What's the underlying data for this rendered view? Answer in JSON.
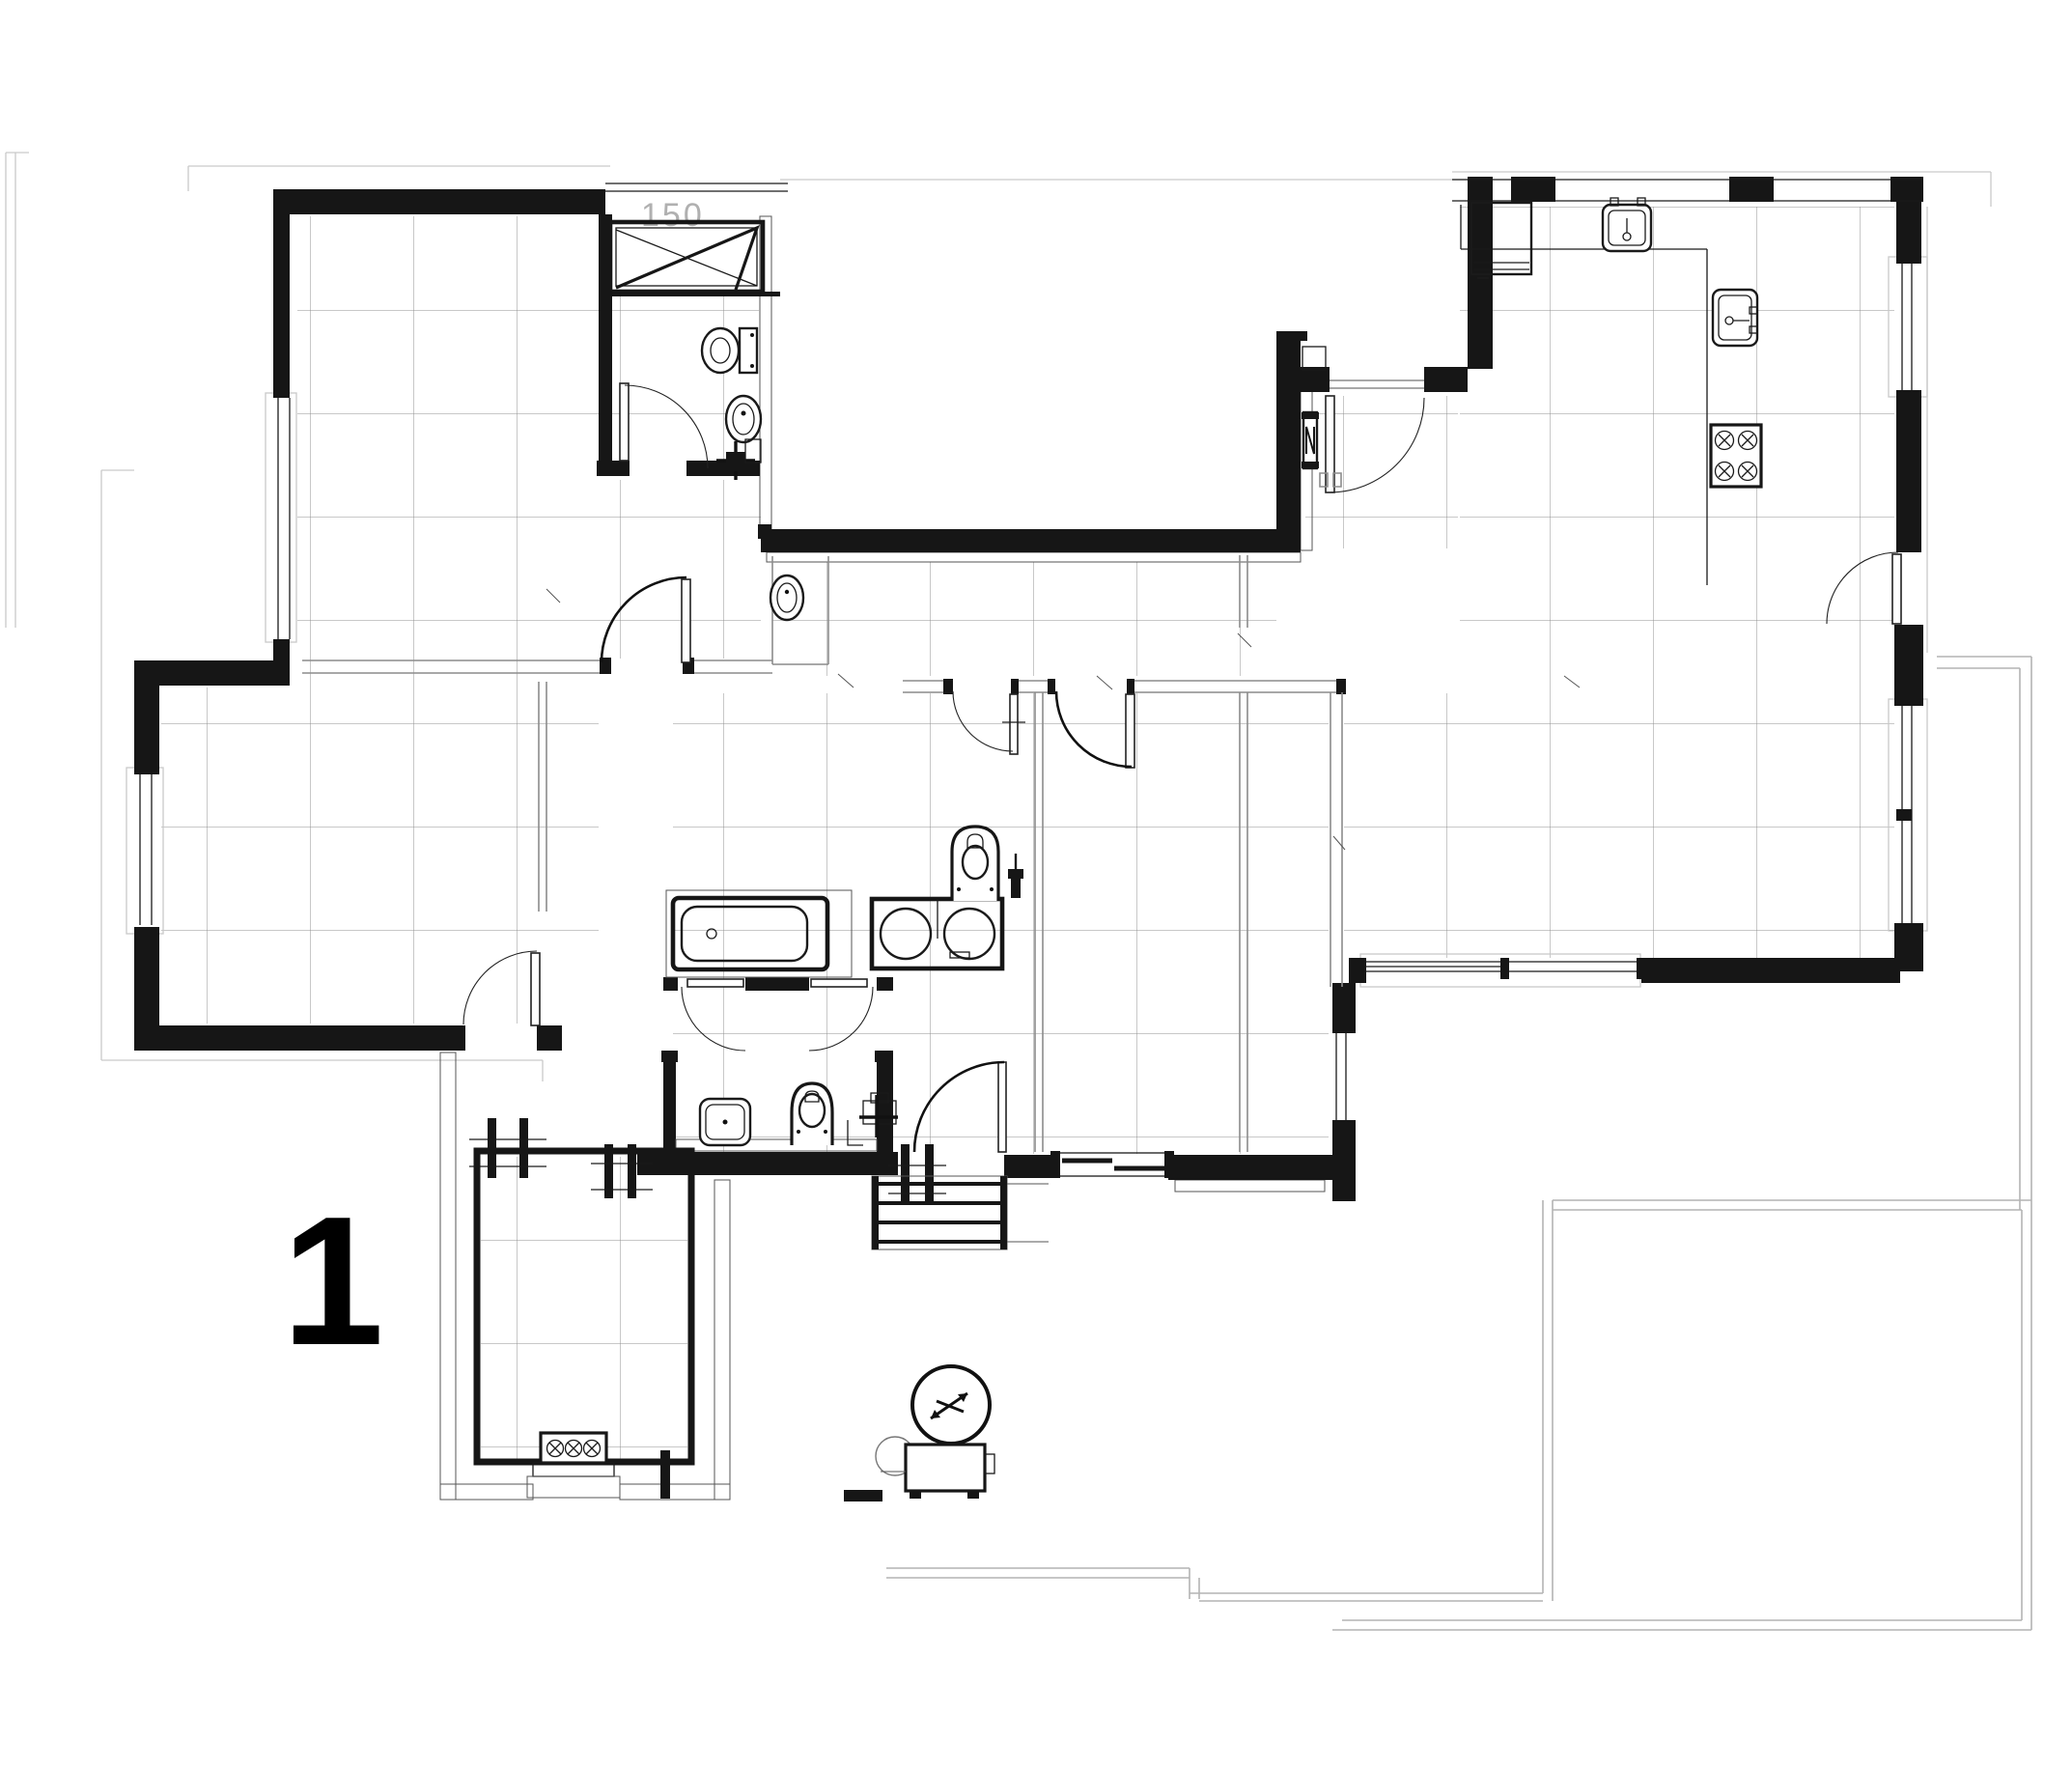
{
  "sheet": {
    "plan_number": "1"
  },
  "annotations": {
    "shower_width_label": "150"
  },
  "drawing": {
    "type": "architectural-floor-plan",
    "rooms": [
      "bedroom-nw",
      "bathroom-nw",
      "entry-hall",
      "kitchen-living",
      "central-bathroom",
      "laundry-bathroom",
      "bedroom-center",
      "bbq-terrace-room",
      "courtyard",
      "patio"
    ],
    "fixtures": [
      "shower-tray",
      "toilet",
      "washbasin",
      "bathtub",
      "double-vanity",
      "kitchen-sink",
      "prep-sink",
      "cooktop-4-burner",
      "refrigerator",
      "bbq-grill",
      "water-heater",
      "hvac-fan",
      "condenser-unit",
      "exterior-stairs"
    ]
  }
}
